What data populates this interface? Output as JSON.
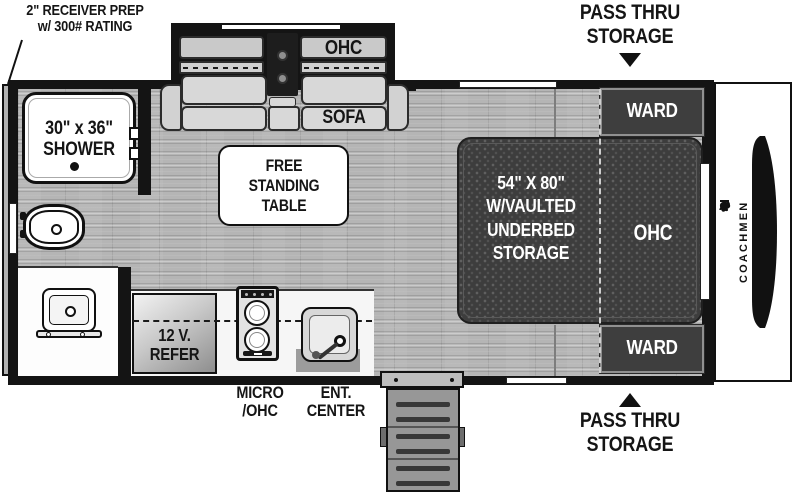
{
  "annotations": {
    "receiver_prep": "2\" RECEIVER PREP\nw/ 300# RATING",
    "pass_thru_storage_top": "PASS THRU\nSTORAGE",
    "pass_thru_storage_bottom": "PASS THRU\nSTORAGE"
  },
  "brand": {
    "name": "COACHMEN"
  },
  "bathroom": {
    "shower": "30\" x 36\"\nSHOWER",
    "med_cab": "MED.\nCAB."
  },
  "living": {
    "ohc": "OHC",
    "sofa": "SOFA",
    "table": "FREE\nSTANDING\nTABLE"
  },
  "kitchen": {
    "refer": "12 V.\nREFER",
    "micro_ohc": "MICRO\n/OHC",
    "ent_center": "ENT.\nCENTER"
  },
  "bedroom": {
    "bed": "54\" X 80\"\nW/VAULTED\nUNDERBED\nSTORAGE",
    "ohc": "OHC",
    "ward_top": "WARD",
    "ward_bottom": "WARD"
  },
  "colors": {
    "wall": "#141414",
    "floor": "#b5b5b5",
    "bed_fill": "#3d3d3d",
    "ward_fill": "#3e3e3e",
    "cushion_fill": "#d8d8d8",
    "label_ink": "#151515"
  }
}
